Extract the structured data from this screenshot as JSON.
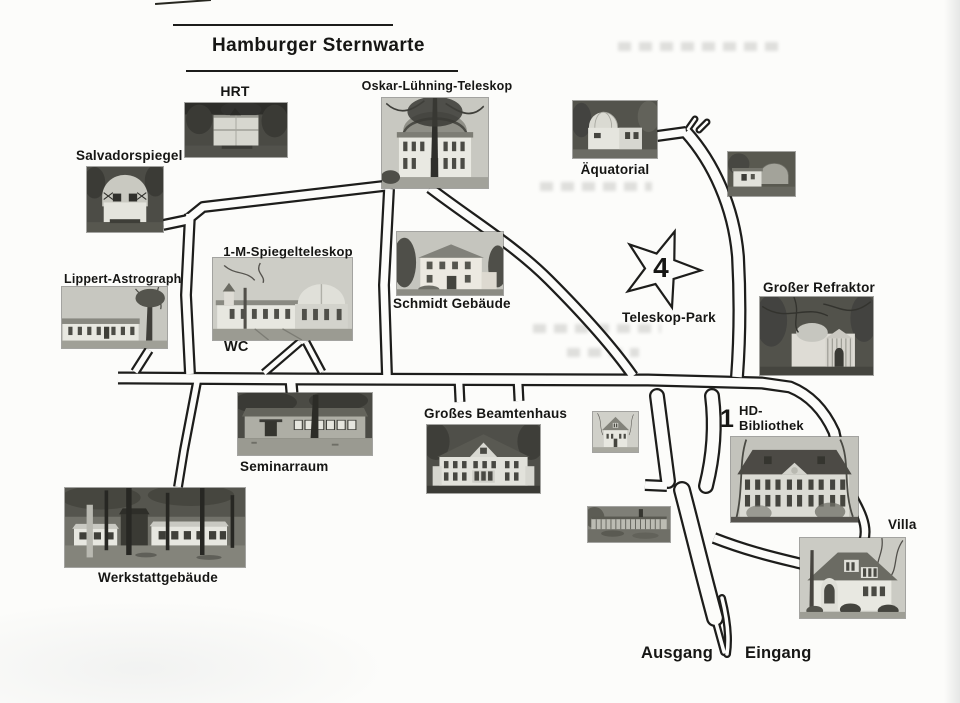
{
  "title": "Hamburger Sternwarte",
  "labels": {
    "hrt": "HRT",
    "oskar_luehning": "Oskar-Lühning-Teleskop",
    "salvadorspiegel": "Salvadorspiegel",
    "aequatorial": "Äquatorial",
    "spiegelteleskop": "1-M-Spiegelteleskop",
    "wc": "WC",
    "schmidt": "Schmidt Gebäude",
    "lippert": "Lippert-Astrograph",
    "grosser_refraktor": "Großer Refraktor",
    "teleskop_park": "Teleskop-Park",
    "grosses_beamtenhaus": "Großes Beamtenhaus",
    "seminarraum": "Seminarraum",
    "hd_bibliothek": "HD-\nBibliothek",
    "villa": "Villa",
    "werkstattgebaeude": "Werkstattgebäude",
    "ausgang": "Ausgang",
    "eingang": "Eingang"
  },
  "markers": {
    "teleskop_park": "4",
    "hd_bibliothek": "1"
  },
  "colors": {
    "ink": "#1d1d1b",
    "paper": "#fcfcfa"
  }
}
